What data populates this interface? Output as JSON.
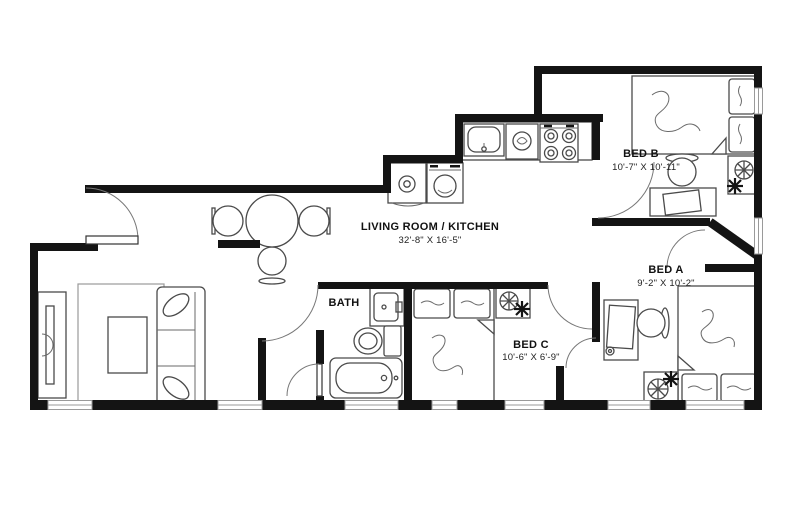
{
  "plan": {
    "background_color": "#ffffff",
    "wall_color": "#141414",
    "furniture_line_color": "#4a4a4a",
    "window_color": "#9a9a9a",
    "rooms": [
      {
        "name": "LIVING ROOM / KITCHEN",
        "dimensions": "32'-8\" X 16'-5\""
      },
      {
        "name": "BED B",
        "dimensions": "10'-7\" X 10'-11\""
      },
      {
        "name": "BED A",
        "dimensions": "9'-2\" X 10'-2\""
      },
      {
        "name": "BED C",
        "dimensions": "10'-6\" X 6'-9\""
      },
      {
        "name": "BATH",
        "dimensions": ""
      }
    ]
  }
}
